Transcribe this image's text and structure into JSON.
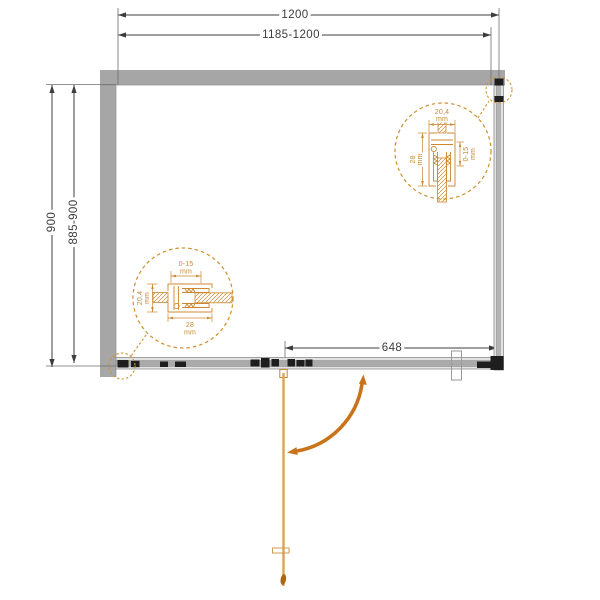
{
  "diagram": {
    "title": "shower-enclosure-installation-top-view",
    "dimensions": {
      "top_outer": "1200",
      "top_inner": "1185-1200",
      "left_outer": "900",
      "left_inner": "885-900",
      "door_width": "648"
    },
    "detail_top_right": {
      "profile_width": "20,4",
      "profile_width_unit": "mm",
      "profile_depth": "28",
      "profile_depth_unit": "mm",
      "adjustment_range": "0-15",
      "adjustment_range_unit": "mm"
    },
    "detail_bottom_left": {
      "adjustment_range": "0-15",
      "adjustment_range_unit": "mm",
      "profile_width": "20,4",
      "profile_width_unit": "mm",
      "profile_depth": "28",
      "profile_depth_unit": "mm"
    },
    "colors": {
      "wall_gray": "#a6a6a6",
      "dimension_line": "#3c3c3c",
      "detail_orange": "#cc8730",
      "arrow_orange": "#c9731a",
      "door_orange": "#dca257"
    }
  }
}
